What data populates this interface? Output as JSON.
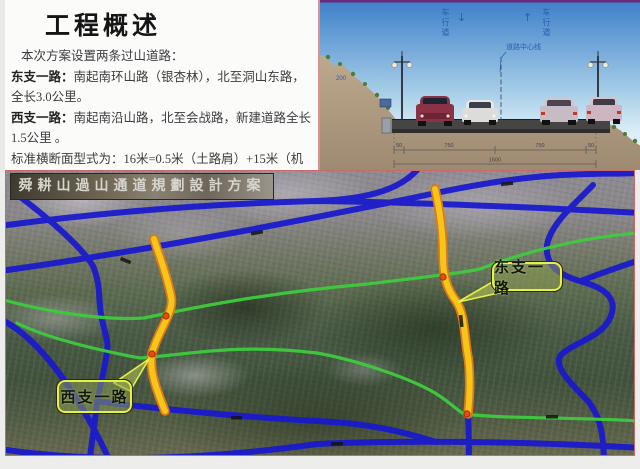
{
  "overview": {
    "title": "工程概述",
    "intro": "本次方案设置两条过山道路：",
    "east_road": {
      "label": "东支一路：",
      "desc": "南起南环山路（银杏林），北至洞山东路，全长3.0公里。"
    },
    "west_road": {
      "label": "西支一路：",
      "desc": "南起南沿山路，北至会战路，新建道路全长1.5公里 。"
    },
    "section_note": "标准横断面型式为：16米=0.5米（土路肩）+15米（机动车道）+0.5米（土路肩）断面布置仅考虑机动车，机动车道双向四车道布置。"
  },
  "cross_section": {
    "lane_label_left": "车行道",
    "lane_label_right": "车行道",
    "arrow_down": "↓",
    "arrow_up": "↑",
    "centerline_label": "道路中心线",
    "slope_elevation": "200",
    "dimensions": {
      "shoulder_left": "50",
      "lane_left": "750",
      "lane_right": "750",
      "shoulder_right": "50",
      "total": "1600"
    }
  },
  "map": {
    "banner": "舜耕山過山通道規劃設計方案",
    "callout_east": "东支一路",
    "callout_west": "西支一路",
    "colors": {
      "planned_road": "#f5c518",
      "planned_road_casing": "#e07818",
      "existing_road": "#1818cf",
      "mountain_road": "#3ecb3e",
      "junction_dot": "#ea4a10"
    }
  }
}
